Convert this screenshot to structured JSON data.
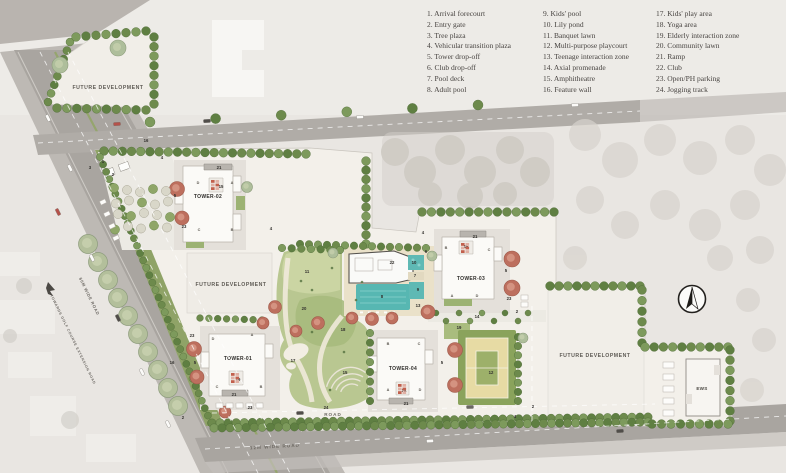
{
  "legend": {
    "items": [
      "1. Arrival forecourt",
      "2. Entry gate",
      "3. Tree plaza",
      "4. Vehicular transition plaza",
      "5. Tower drop-off",
      "6. Club drop-off",
      "7. Pool deck",
      "8. Adult pool",
      "9. Kids' pool",
      "10. Lily pond",
      "11. Banquet lawn",
      "12. Multi-purpose playcourt",
      "13. Teenage interaction zone",
      "14. Axial promenade",
      "15. Amphitheatre",
      "16. Feature wall",
      "17. Kids' play area",
      "18. Yoga area",
      "19. Elderly interaction zone",
      "20. Community lawn",
      "21. Ramp",
      "22. Club",
      "23. Open/PH parking",
      "24. Jogging track"
    ]
  },
  "plan": {
    "future_development": "FUTURE DEVELOPMENT",
    "towers": [
      "TOWER-01",
      "TOWER-02",
      "TOWER-03",
      "TOWER-04"
    ],
    "ews": "EWS",
    "road": "ROAD",
    "road_12m": "12M WIDE ROAD",
    "road_60m": "60M WIDE ROAD",
    "towards_road": "TOWARDS GOLF COURSE EXTENSION ROAD"
  },
  "markers": [
    {
      "t": "1",
      "x": 103,
      "y": 163
    },
    {
      "t": "2",
      "x": 113,
      "y": 176
    },
    {
      "t": "3",
      "x": 90,
      "y": 169
    },
    {
      "t": "4",
      "x": 162,
      "y": 159
    },
    {
      "t": "16",
      "x": 146,
      "y": 142
    },
    {
      "t": "5",
      "x": 175,
      "y": 197
    },
    {
      "t": "21",
      "x": 219,
      "y": 169
    },
    {
      "t": "15",
      "x": 221,
      "y": 188
    },
    {
      "t": "23",
      "x": 184,
      "y": 228
    },
    {
      "t": "4",
      "x": 271,
      "y": 230
    },
    {
      "t": "11",
      "x": 307,
      "y": 273
    },
    {
      "t": "20",
      "x": 304,
      "y": 310
    },
    {
      "t": "18",
      "x": 343,
      "y": 331
    },
    {
      "t": "17",
      "x": 293,
      "y": 362
    },
    {
      "t": "15",
      "x": 345,
      "y": 374
    },
    {
      "t": "24",
      "x": 326,
      "y": 409
    },
    {
      "t": "14",
      "x": 477,
      "y": 318
    },
    {
      "t": "22",
      "x": 392,
      "y": 264
    },
    {
      "t": "10",
      "x": 414,
      "y": 264
    },
    {
      "t": "7",
      "x": 415,
      "y": 277
    },
    {
      "t": "8",
      "x": 382,
      "y": 298
    },
    {
      "t": "9",
      "x": 418,
      "y": 291
    },
    {
      "t": "13",
      "x": 418,
      "y": 307
    },
    {
      "t": "6",
      "x": 426,
      "y": 253
    },
    {
      "t": "4",
      "x": 423,
      "y": 234
    },
    {
      "t": "21",
      "x": 475,
      "y": 238
    },
    {
      "t": "15",
      "x": 466,
      "y": 248
    },
    {
      "t": "5",
      "x": 506,
      "y": 272
    },
    {
      "t": "23",
      "x": 509,
      "y": 300
    },
    {
      "t": "2",
      "x": 517,
      "y": 313
    },
    {
      "t": "19",
      "x": 459,
      "y": 329
    },
    {
      "t": "12",
      "x": 491,
      "y": 374
    },
    {
      "t": "5",
      "x": 442,
      "y": 364
    },
    {
      "t": "21",
      "x": 406,
      "y": 405
    },
    {
      "t": "24",
      "x": 404,
      "y": 392
    },
    {
      "t": "23",
      "x": 192,
      "y": 337
    },
    {
      "t": "5",
      "x": 195,
      "y": 364
    },
    {
      "t": "19",
      "x": 238,
      "y": 381
    },
    {
      "t": "21",
      "x": 234,
      "y": 396
    },
    {
      "t": "23",
      "x": 250,
      "y": 409
    },
    {
      "t": "2",
      "x": 183,
      "y": 419
    },
    {
      "t": "16",
      "x": 172,
      "y": 364
    },
    {
      "t": "4",
      "x": 515,
      "y": 418
    },
    {
      "t": "2",
      "x": 533,
      "y": 408
    }
  ],
  "unit_letters": [
    {
      "t": "D",
      "x": 198,
      "y": 184
    },
    {
      "t": "A",
      "x": 232,
      "y": 184
    },
    {
      "t": "C",
      "x": 199,
      "y": 231
    },
    {
      "t": "B",
      "x": 232,
      "y": 231
    },
    {
      "t": "D",
      "x": 213,
      "y": 340
    },
    {
      "t": "A",
      "x": 252,
      "y": 336
    },
    {
      "t": "C",
      "x": 217,
      "y": 388
    },
    {
      "t": "B",
      "x": 261,
      "y": 388
    },
    {
      "t": "B",
      "x": 446,
      "y": 249
    },
    {
      "t": "C",
      "x": 489,
      "y": 251
    },
    {
      "t": "A",
      "x": 452,
      "y": 297
    },
    {
      "t": "D",
      "x": 477,
      "y": 297
    },
    {
      "t": "B",
      "x": 388,
      "y": 345
    },
    {
      "t": "C",
      "x": 419,
      "y": 345
    },
    {
      "t": "A",
      "x": 388,
      "y": 391
    },
    {
      "t": "D",
      "x": 420,
      "y": 391
    }
  ],
  "colors": {
    "site": "#f3f0ea",
    "road": "#aaa6a1",
    "lawn": "#b9c791",
    "pool": "#57b7b2",
    "hedge": "#6d8a4c",
    "orange_tree": "#bd6f5e",
    "court": "#e7dba4"
  }
}
